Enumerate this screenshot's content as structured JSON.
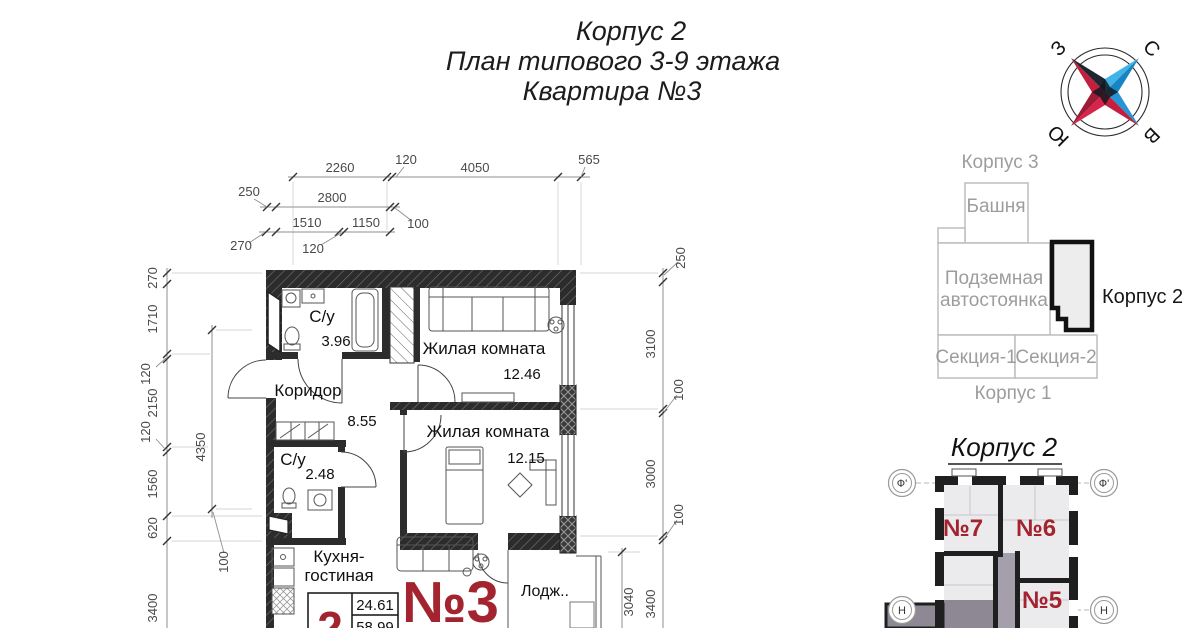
{
  "title": {
    "l1": "Корпус 2",
    "l2": "План типового 3-9 этажа",
    "l3": "Квартира №3"
  },
  "compass": {
    "n": "С",
    "e": "В",
    "s": "Ю",
    "w": "З",
    "blue": "#41b3e6",
    "red": "#c41f3f"
  },
  "site_plan": {
    "korpus3": "Корпус 3",
    "tower": "Башня",
    "parking_line1": "Подземная",
    "parking_line2": "автостоянка",
    "korpus2": "Корпус 2",
    "section1": "Секция-1",
    "section2": "Секция-2",
    "korpus1": "Корпус 1"
  },
  "mini_plan": {
    "title": "Корпус 2",
    "axis_f": "Ф'",
    "axis_h": "Н",
    "apt7": "№7",
    "apt6": "№6",
    "apt5": "№5",
    "accent": "#a3242e"
  },
  "floor_plan": {
    "apartment_no": "№3",
    "rooms": {
      "bath1": {
        "name": "С/у",
        "area": "3.96"
      },
      "living1": {
        "name": "Жилая комната",
        "area": "12.46"
      },
      "corridor": {
        "name": "Коридор",
        "area": "8.55"
      },
      "living2": {
        "name": "Жилая комната",
        "area": "12.15"
      },
      "bath2": {
        "name": "С/у",
        "area": "2.48"
      },
      "kitchen_line1": "Кухня-",
      "kitchen_line2": "гостиная",
      "loggia": "Лодж.."
    },
    "summary": {
      "rooms_count": "2",
      "living_area": "24.61",
      "total_area": "58.99"
    },
    "dims": {
      "h1": [
        "2260",
        "120",
        "4050",
        "565"
      ],
      "h2": [
        "250",
        "2800",
        "100"
      ],
      "h3": [
        "270",
        "1510",
        "120",
        "1150"
      ],
      "vl": [
        "270",
        "1710",
        "120",
        "2150",
        "120",
        "1560",
        "620",
        "3400"
      ],
      "vli": [
        "4350",
        "100"
      ],
      "vr": [
        "250",
        "3100",
        "100",
        "3000",
        "100",
        "3400"
      ],
      "vri": [
        "3040"
      ]
    }
  }
}
